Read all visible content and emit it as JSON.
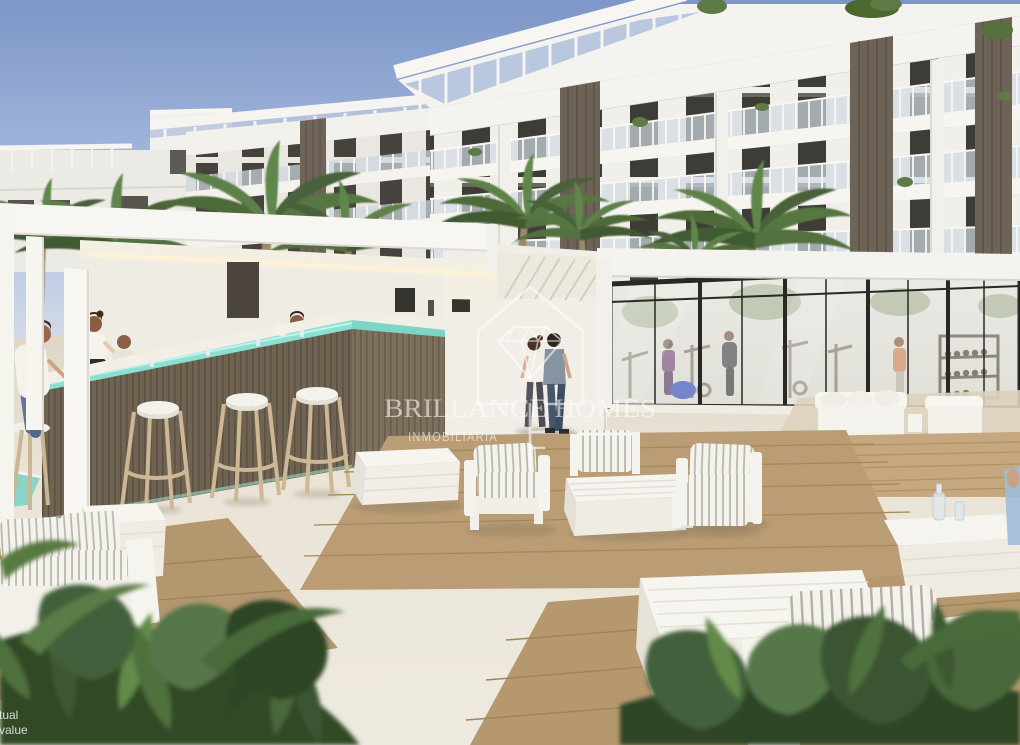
{
  "image": {
    "kind": "architectural-render",
    "caption": "New-build apartment complex exterior with pool bar, glass gym pavilion and outdoor lounge terrace"
  },
  "watermark": {
    "logo_icon": "house-diamond-icon",
    "title": "BRILLANCE HOMES",
    "subtitle": "INMOBILIARIA"
  },
  "corner_watermark": {
    "line1": "ctual",
    "line2": "l value"
  },
  "palette": {
    "sky_top": "#7D96C8",
    "sky_horizon": "#CDD6E5",
    "facade_white": "#F4F2EE",
    "accent_panel_bronze": "#6D6356",
    "window_dark": "#3E3C36",
    "bar_led_teal": "#8CE0D2",
    "bar_wood": "#6F6352",
    "stone_floor": "#EAE4D7",
    "deck_wood": "#B99C76",
    "foliage_green": "#4F6B3B",
    "watermark_white": "rgba(255,255,255,0.58)"
  },
  "scene": {
    "building": {
      "label": "apartment building",
      "floors_visible": 5,
      "features": [
        "glass balcony railings",
        "bronze slat accent panels",
        "rooftop terrace railing"
      ]
    },
    "pool_bar": {
      "label": "pool bar",
      "bar_stools": 4,
      "staff_count": 2,
      "seated_guests": 2,
      "led_accent": "teal strip under counter"
    },
    "gym": {
      "label": "glass gym pavilion",
      "people_count": 3,
      "details": [
        "black framed glazing",
        "blue exercise ball",
        "weight racks"
      ]
    },
    "terrace": {
      "label": "lounge terrace",
      "lounge_sets": 4,
      "cushions": "white with grey pinstripes",
      "rugs": "natural wood decking"
    },
    "walking_couple": 2,
    "landscaping": [
      "palm trees",
      "tropical foreground plants"
    ]
  }
}
